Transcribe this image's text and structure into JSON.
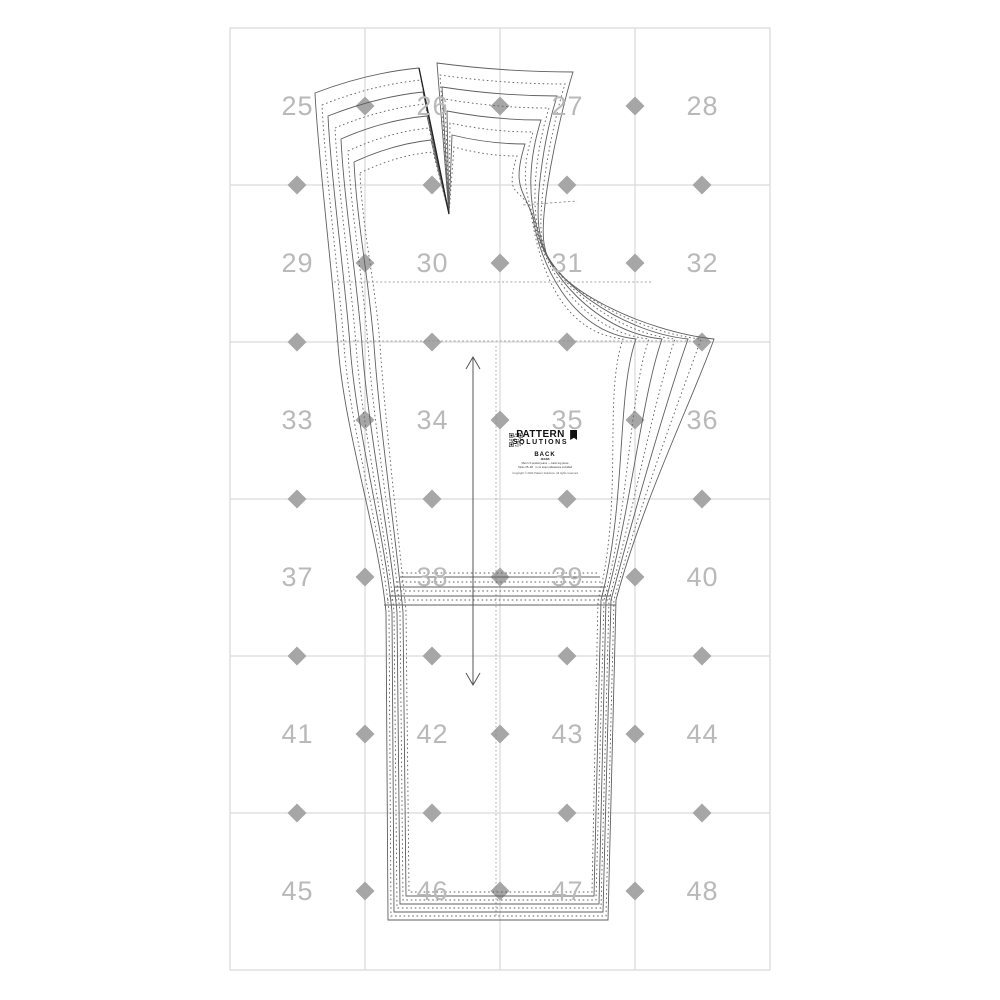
{
  "page": {
    "background": "#ffffff"
  },
  "grid": {
    "numbers": [
      "25",
      "26",
      "27",
      "28",
      "29",
      "30",
      "31",
      "32",
      "33",
      "34",
      "35",
      "36",
      "37",
      "38",
      "39",
      "40",
      "41",
      "42",
      "43",
      "44",
      "45",
      "46",
      "47",
      "48"
    ],
    "line_color": "#d9d9d9",
    "number_color": "#b9b9b9",
    "marker_color": "#a6a6a6"
  },
  "pattern": {
    "brand": {
      "line1": "PATTERN",
      "line2": "SOLUTIONS"
    },
    "piece_label": "BACK",
    "style_label": "JEANS",
    "info_line1": "Men's 5-pocket jeans — back leg piece",
    "info_line2": "Sizes 25–48 · 1 cm seam allowance included",
    "copyright": "Copyright © 2024 Pattern Solutions. All rights reserved.",
    "line_color": "#5f5f5f",
    "dart_color": "#222222"
  },
  "icons": {
    "alignment_marker": "diamond",
    "grainline_arrow": "double-headed-vertical-arrow",
    "qr_code": "qr-code",
    "brand_mark": "flag-bookmark"
  }
}
